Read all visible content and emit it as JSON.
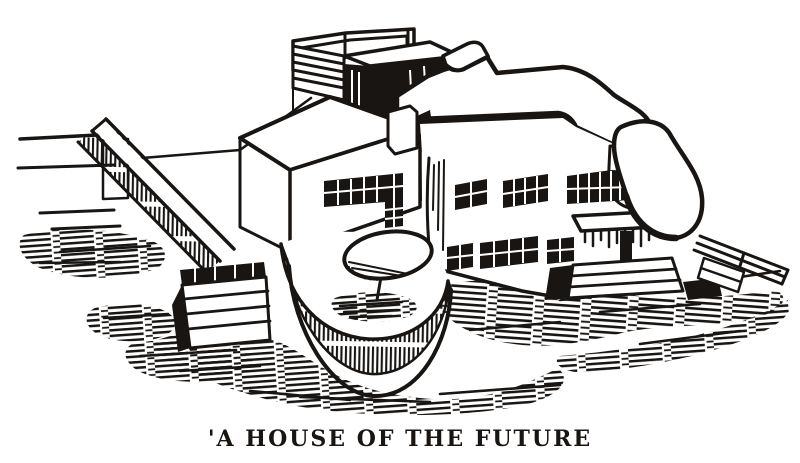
{
  "colors": {
    "ink": "#181512",
    "paper": "#ffffff"
  },
  "illustration": {
    "alt": "Black ink engraving of a modernist flat-roofed house with a rooftop railing, banded window strips, a round front terrace with a garden umbrella, a curved entrance canopy and steps, surrounded by hatched ground shadows",
    "caption": "'A HOUSE OF THE FUTURE"
  }
}
